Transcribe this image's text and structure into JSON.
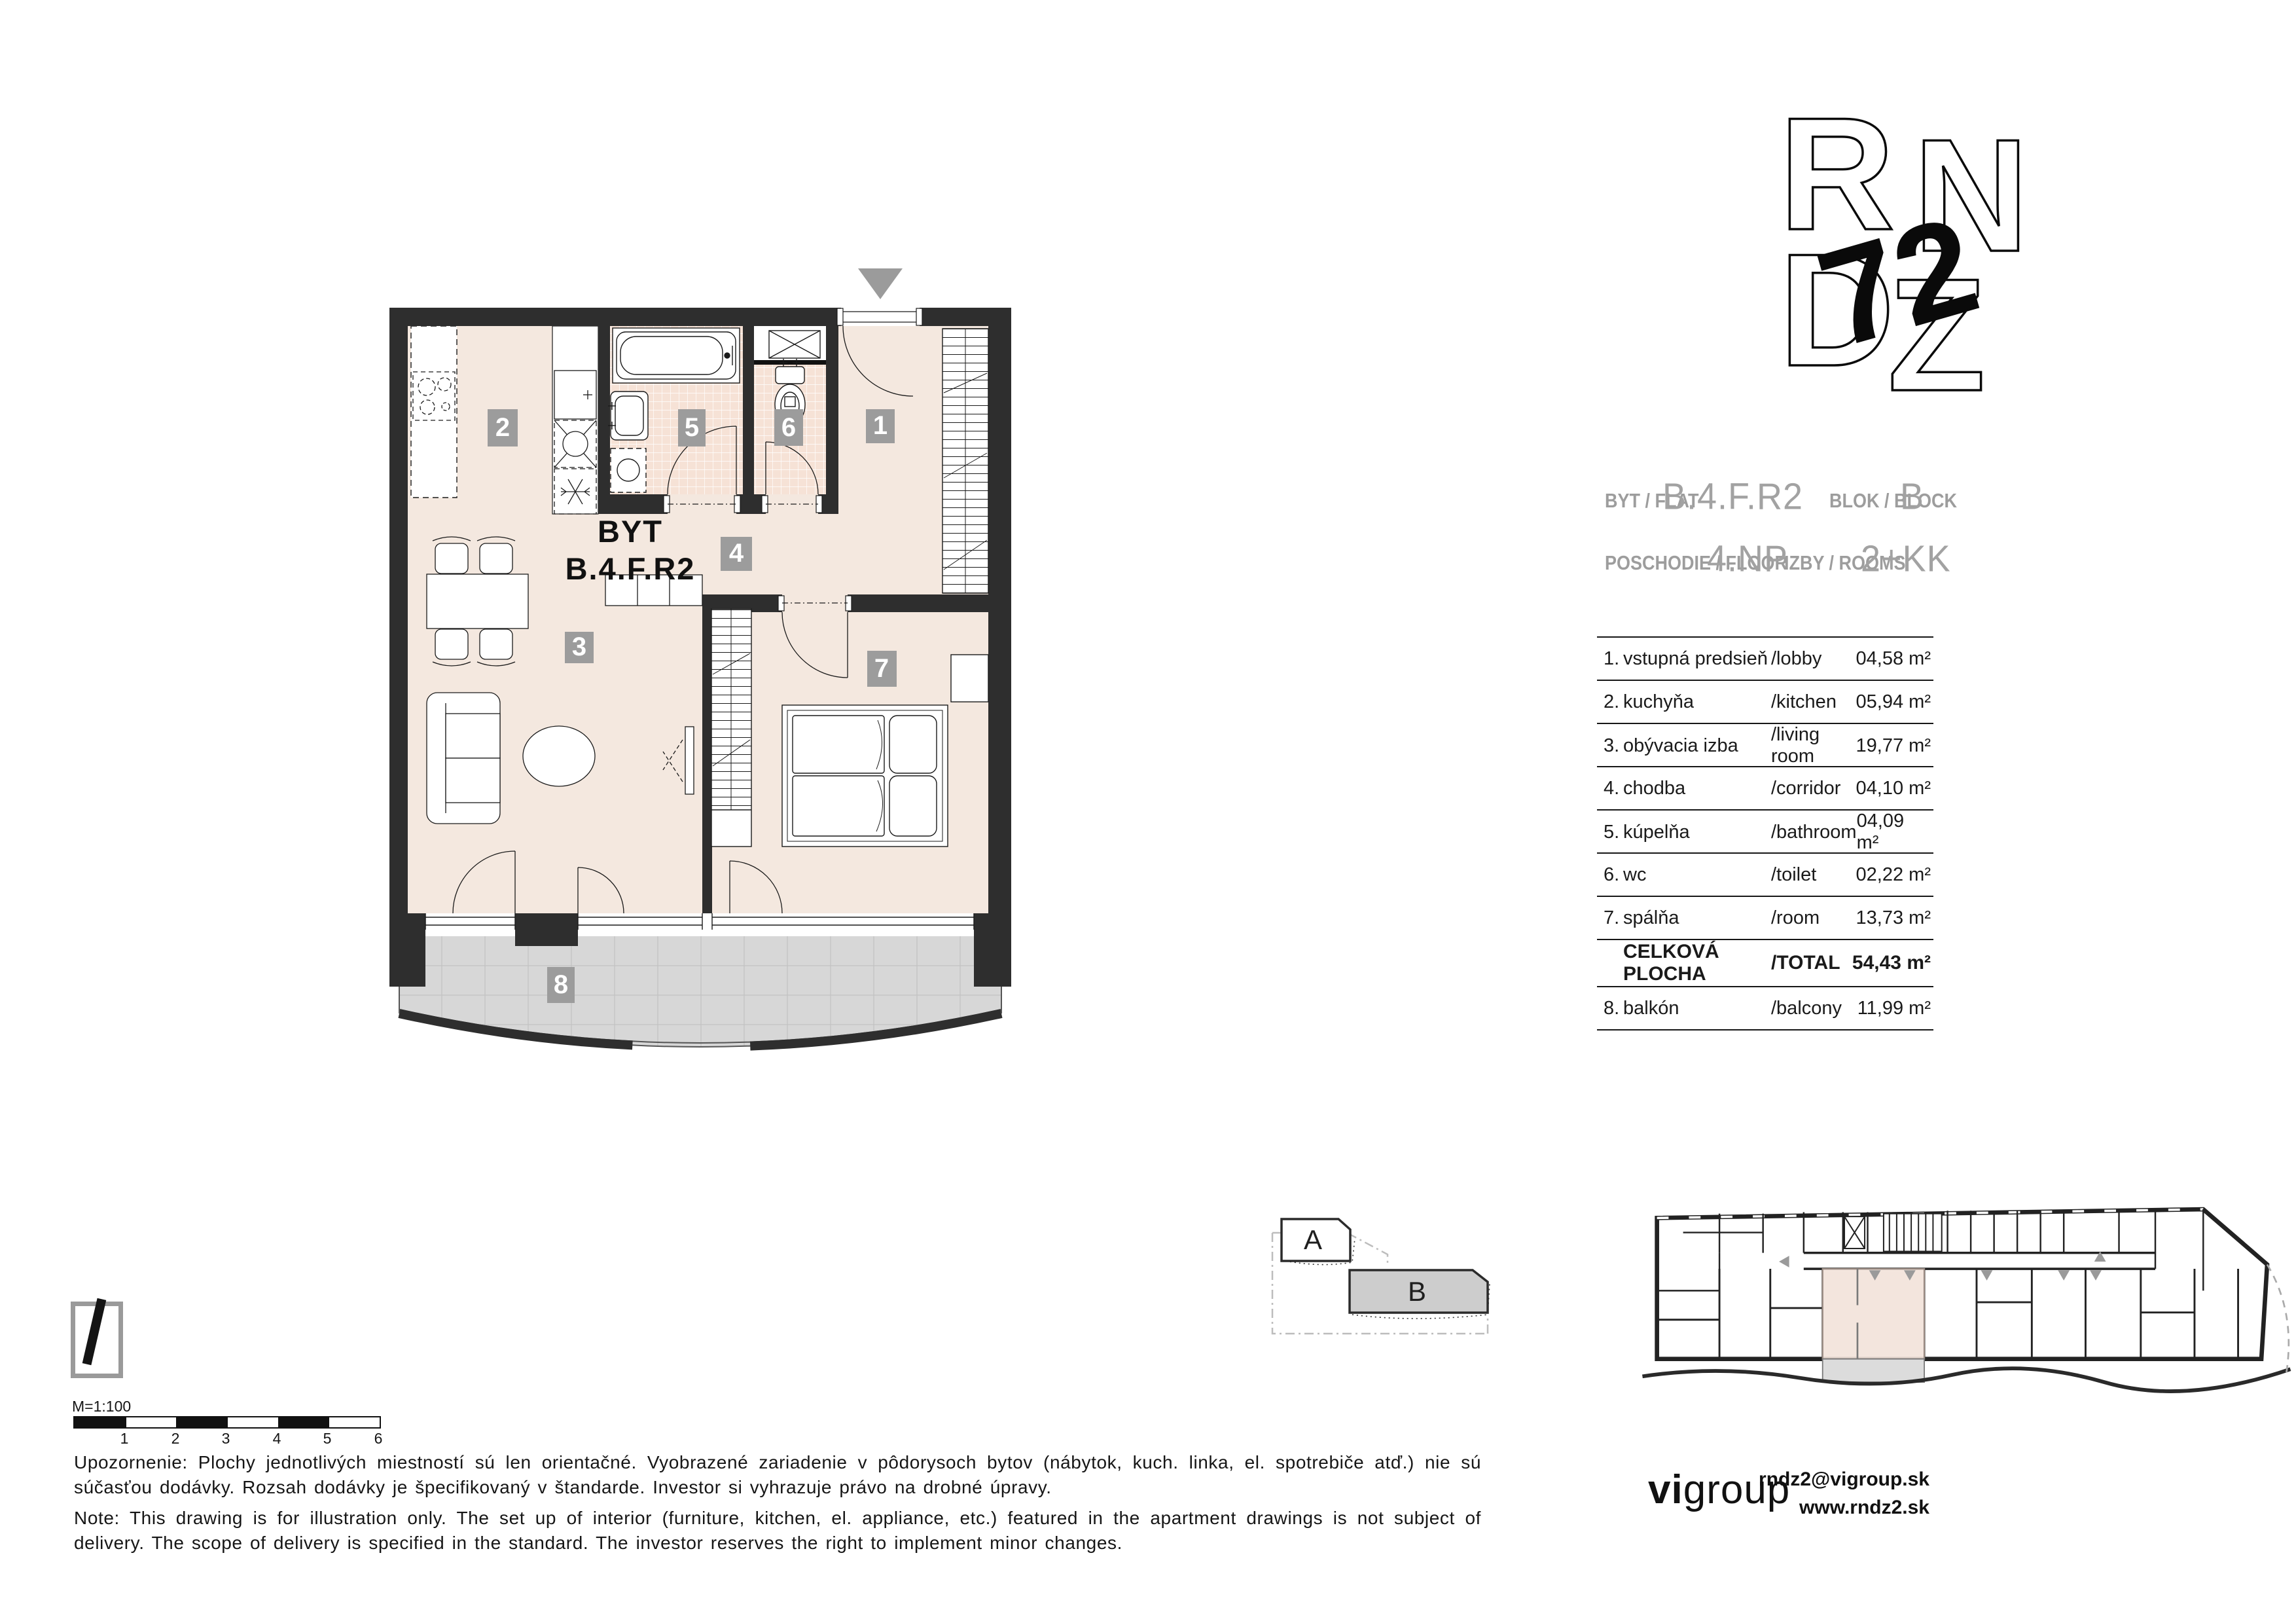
{
  "plan": {
    "title_line1": "BYT",
    "title_line2": "B.4.F.R2",
    "badges": [
      "1",
      "2",
      "3",
      "4",
      "5",
      "6",
      "7",
      "8"
    ]
  },
  "header": {
    "flat_label": "BYT / FLAT",
    "flat_value": "B.4.F.R2",
    "block_label": "BLOK / BLOCK",
    "block_value": "B",
    "floor_label": "POSCHODIE / FLOOR",
    "floor_value": "4.NP",
    "rooms_label": "IZBY / ROOMS",
    "rooms_value": "2+KK"
  },
  "rooms_table": {
    "rows": [
      {
        "num": "1.",
        "sk": "vstupná predsieň",
        "en": "/lobby",
        "area": "04,58 m²"
      },
      {
        "num": "2.",
        "sk": "kuchyňa",
        "en": "/kitchen",
        "area": "05,94 m²"
      },
      {
        "num": "3.",
        "sk": "obývacia izba",
        "en": "/living room",
        "area": "19,77 m²"
      },
      {
        "num": "4.",
        "sk": "chodba",
        "en": "/corridor",
        "area": "04,10 m²"
      },
      {
        "num": "5.",
        "sk": "kúpelňa",
        "en": "/bathroom",
        "area": "04,09 m²"
      },
      {
        "num": "6.",
        "sk": "wc",
        "en": "/toilet",
        "area": "02,22 m²"
      },
      {
        "num": "7.",
        "sk": "spálňa",
        "en": "/room",
        "area": "13,73 m²"
      },
      {
        "num": "",
        "sk": "CELKOVÁ PLOCHA",
        "en": "/TOTAL",
        "area": "54,43 m²",
        "bold": true
      },
      {
        "num": "8.",
        "sk": "balkón",
        "en": "/balcony",
        "area": "11,99 m²"
      }
    ]
  },
  "locator": {
    "block_a": "A",
    "block_b": "B"
  },
  "scale": {
    "label": "M=1:100",
    "ticks": [
      "1",
      "2",
      "3",
      "4",
      "5",
      "6"
    ]
  },
  "notes": {
    "sk": "Upozornenie: Plochy jednotlivých miestností sú len orientačné. Vyobrazené zariadenie v pôdorysoch bytov (nábytok, kuch. linka, el. spotrebiče atď.) nie sú súčasťou dodávky. Rozsah dodávky je špecifikovaný v štandarde. Investor si vyhrazuje právo na drobné úpravy.",
    "en": "Note: This drawing is for illustration only. The set up of interior (furniture, kitchen, el. appliance, etc.) featured in the apartment drawings is not subject of delivery. The scope of delivery is specified in the standard. The investor reserves the right to implement minor changes."
  },
  "footer": {
    "logo_vi": "vi",
    "logo_group": "group",
    "email": "rndz2@vigroup.sk",
    "web": "www.rndz2.sk"
  },
  "logo": {
    "l1": "R",
    "l2": "N",
    "l3": "D",
    "l4": "Z",
    "mark": "72"
  },
  "colors": {
    "wall": "#2e2e2e",
    "floor": "#f4e8df",
    "tile": "#f6e2d6",
    "balcony": "#d7d7d7",
    "badge": "#9c9c9c",
    "accent_gray": "#9b9b9b"
  }
}
